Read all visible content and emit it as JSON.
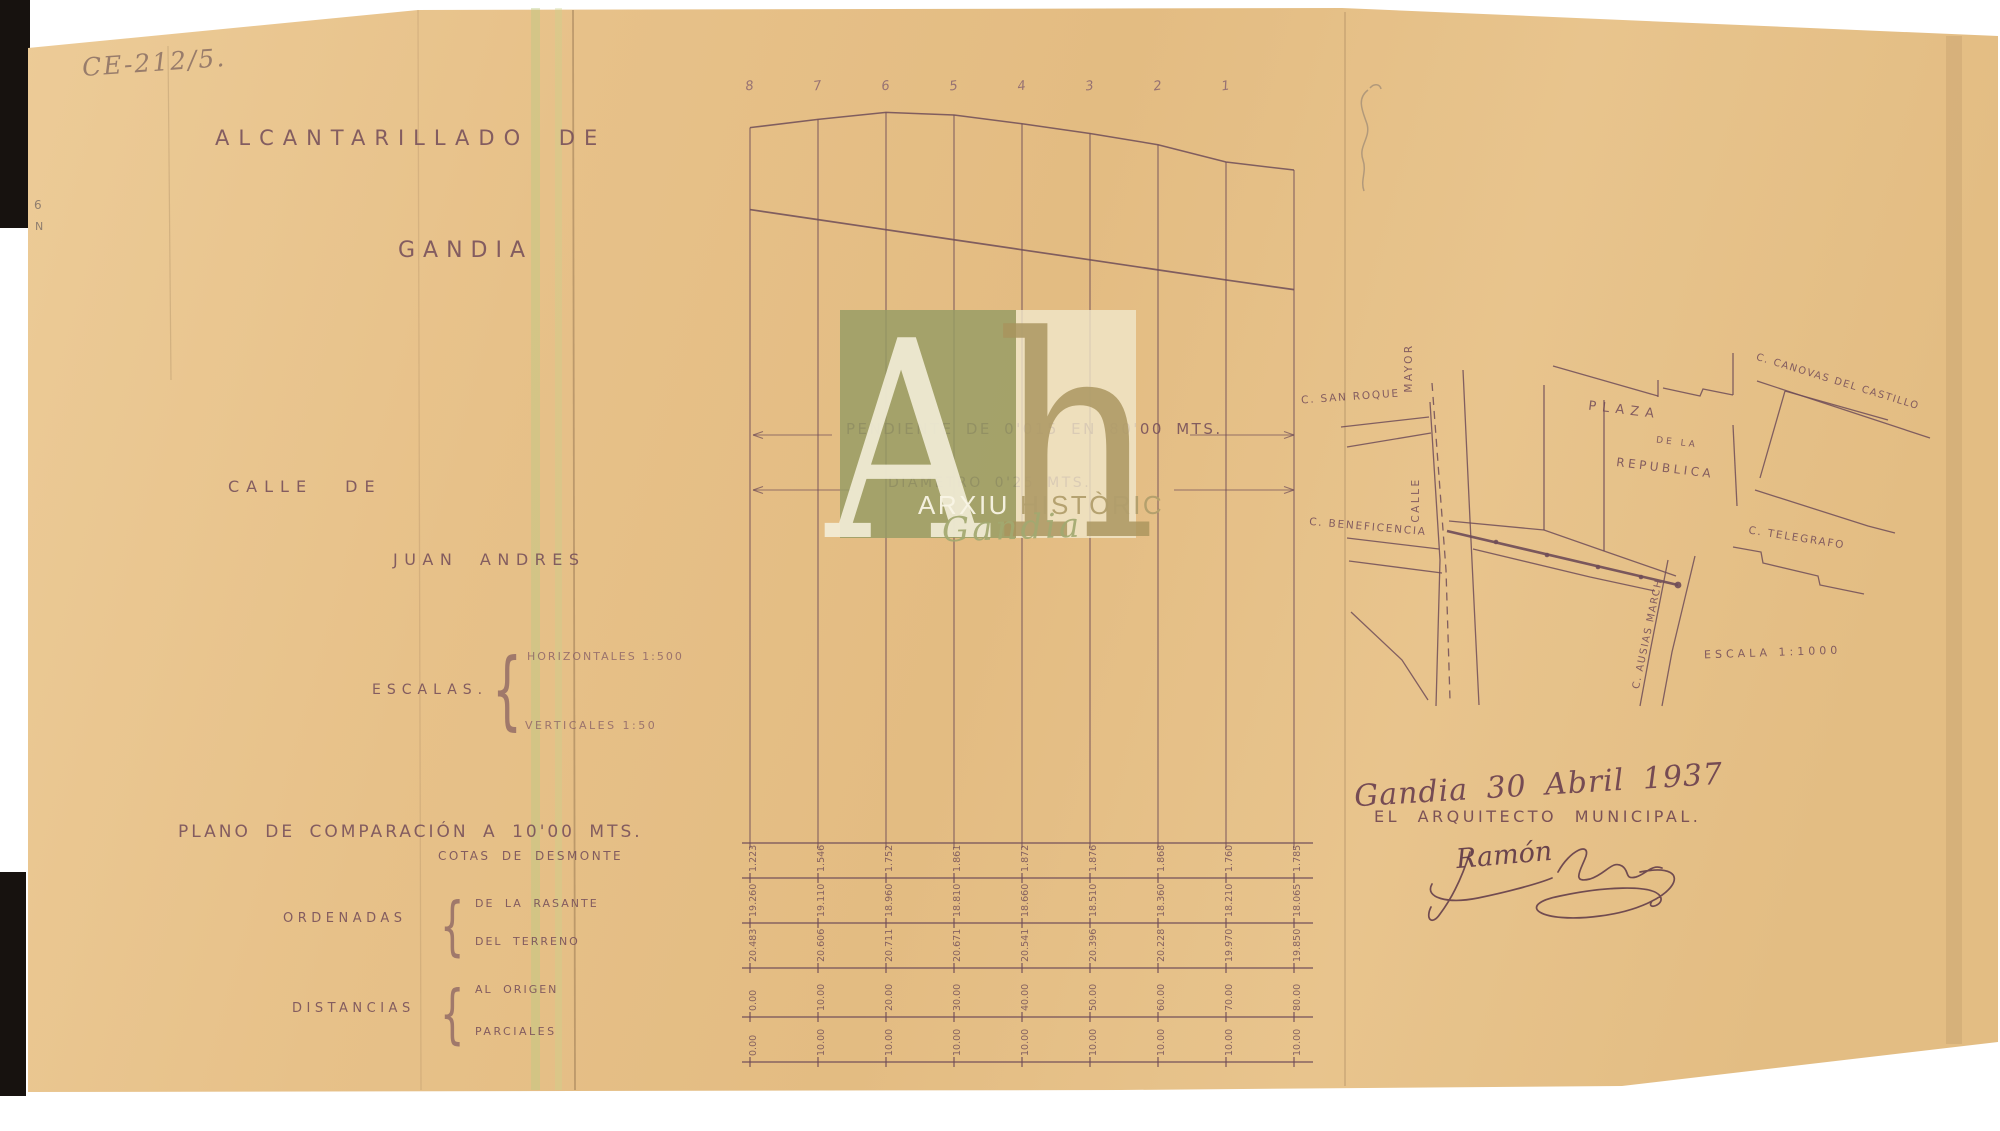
{
  "document": {
    "reference_code": "CE-212/5.",
    "margin_marks": [
      "6",
      "N"
    ],
    "title": {
      "line1": "ALCANTARILLADO DE",
      "line2": "GANDIA"
    },
    "street": {
      "line1": "CALLE DE",
      "line2": "JUAN ANDRES"
    },
    "scales": {
      "label": "ESCALAS.",
      "horizontal": "HORIZONTALES 1:500",
      "vertical": "VERTICALES 1:50"
    },
    "datum_line": "PLANO DE COMPARACIÓN A 10'00 MTS.",
    "datum_note": "COTAS DE DESMONTE",
    "ordinates": {
      "label": "ORDENADAS",
      "items": [
        "DE LA RASANTE",
        "DEL TERRENO"
      ]
    },
    "distances": {
      "label": "DISTANCIAS",
      "items": [
        "AL ORIGEN",
        "PARCIALES"
      ]
    },
    "date_place": "Gandia 30 Abril 1937",
    "signer_title": "EL ARQUITECTO MUNICIPAL.",
    "signature_visible_name": "Ramón"
  },
  "profile": {
    "station_labels": [
      "8",
      "7",
      "6",
      "5",
      "4",
      "3",
      "2",
      "1"
    ],
    "slope_label": "PENDIENTE DE 0'015 EN 80'00 MTS.",
    "diameter_label": "DIAMETRO 0'25 MTS."
  },
  "chart_data": {
    "type": "line",
    "title": "Perfil longitudinal del alcantarillado de la Calle de Juan Andrés",
    "x": [
      0,
      10,
      20,
      30,
      40,
      50,
      60,
      70,
      80
    ],
    "xlabel": "Distancias al origen (mts.)",
    "ylabel": "Ordenadas sobre plano de comparación a 10'00 mts.",
    "series": [
      {
        "name": "Ordenadas del terreno",
        "values": [
          20.483,
          20.606,
          20.711,
          20.671,
          20.541,
          20.396,
          20.228,
          19.97,
          19.85
        ]
      },
      {
        "name": "Ordenadas de la rasante",
        "values": [
          19.26,
          19.11,
          18.96,
          18.81,
          18.66,
          18.51,
          18.36,
          18.21,
          18.065
        ]
      }
    ],
    "table_rows": [
      {
        "name": "cotas_de_desmonte",
        "values": [
          "1.223",
          "1.546",
          "1.752",
          "1.861",
          "1.872",
          "1.876",
          "1.868",
          "1.760",
          "1.785"
        ]
      },
      {
        "name": "ordenadas_de_la_rasante",
        "values": [
          "19.260",
          "19.110",
          "18.960",
          "18.810",
          "18.660",
          "18.510",
          "18.360",
          "18.210",
          "18.065"
        ]
      },
      {
        "name": "ordenadas_del_terreno",
        "values": [
          "20.483",
          "20.606",
          "20.711",
          "20.671",
          "20.541",
          "20.396",
          "20.228",
          "19.970",
          "19.850"
        ]
      },
      {
        "name": "distancias_al_origen",
        "values": [
          "0.00",
          "10.00",
          "20.00",
          "30.00",
          "40.00",
          "50.00",
          "60.00",
          "70.00",
          "80.00"
        ]
      },
      {
        "name": "distancias_parciales",
        "values": [
          "0.00",
          "10.00",
          "10.00",
          "10.00",
          "10.00",
          "10.00",
          "10.00",
          "10.00",
          "10.00"
        ]
      }
    ]
  },
  "map": {
    "labels": {
      "san_roque": "C. SAN ROQUE",
      "mayor": "MAYOR",
      "calle": "CALLE",
      "beneficencia": "C. BENEFICENCIA",
      "plaza_line1": "PLAZA",
      "plaza_line2": "DE LA",
      "plaza_line3": "REPUBLICA",
      "canovas": "C. CANOVAS DEL CASTILLO",
      "telegrafo": "C. TELEGRAFO",
      "ausias_march": "C. AUSIAS MARCH",
      "scale": "ESCALA 1:1000"
    }
  },
  "watermark": {
    "initial_a": "A",
    "initial_h": "h",
    "line1": "ARXIU",
    "line2": "HISTÒRIC",
    "script": "Gandia"
  },
  "colors": {
    "paper": "#e7c28a",
    "ink": "#6f4c58",
    "pencil": "#8f8178",
    "watermark_olive": "#969c64",
    "watermark_cream": "#f0e7cb"
  }
}
